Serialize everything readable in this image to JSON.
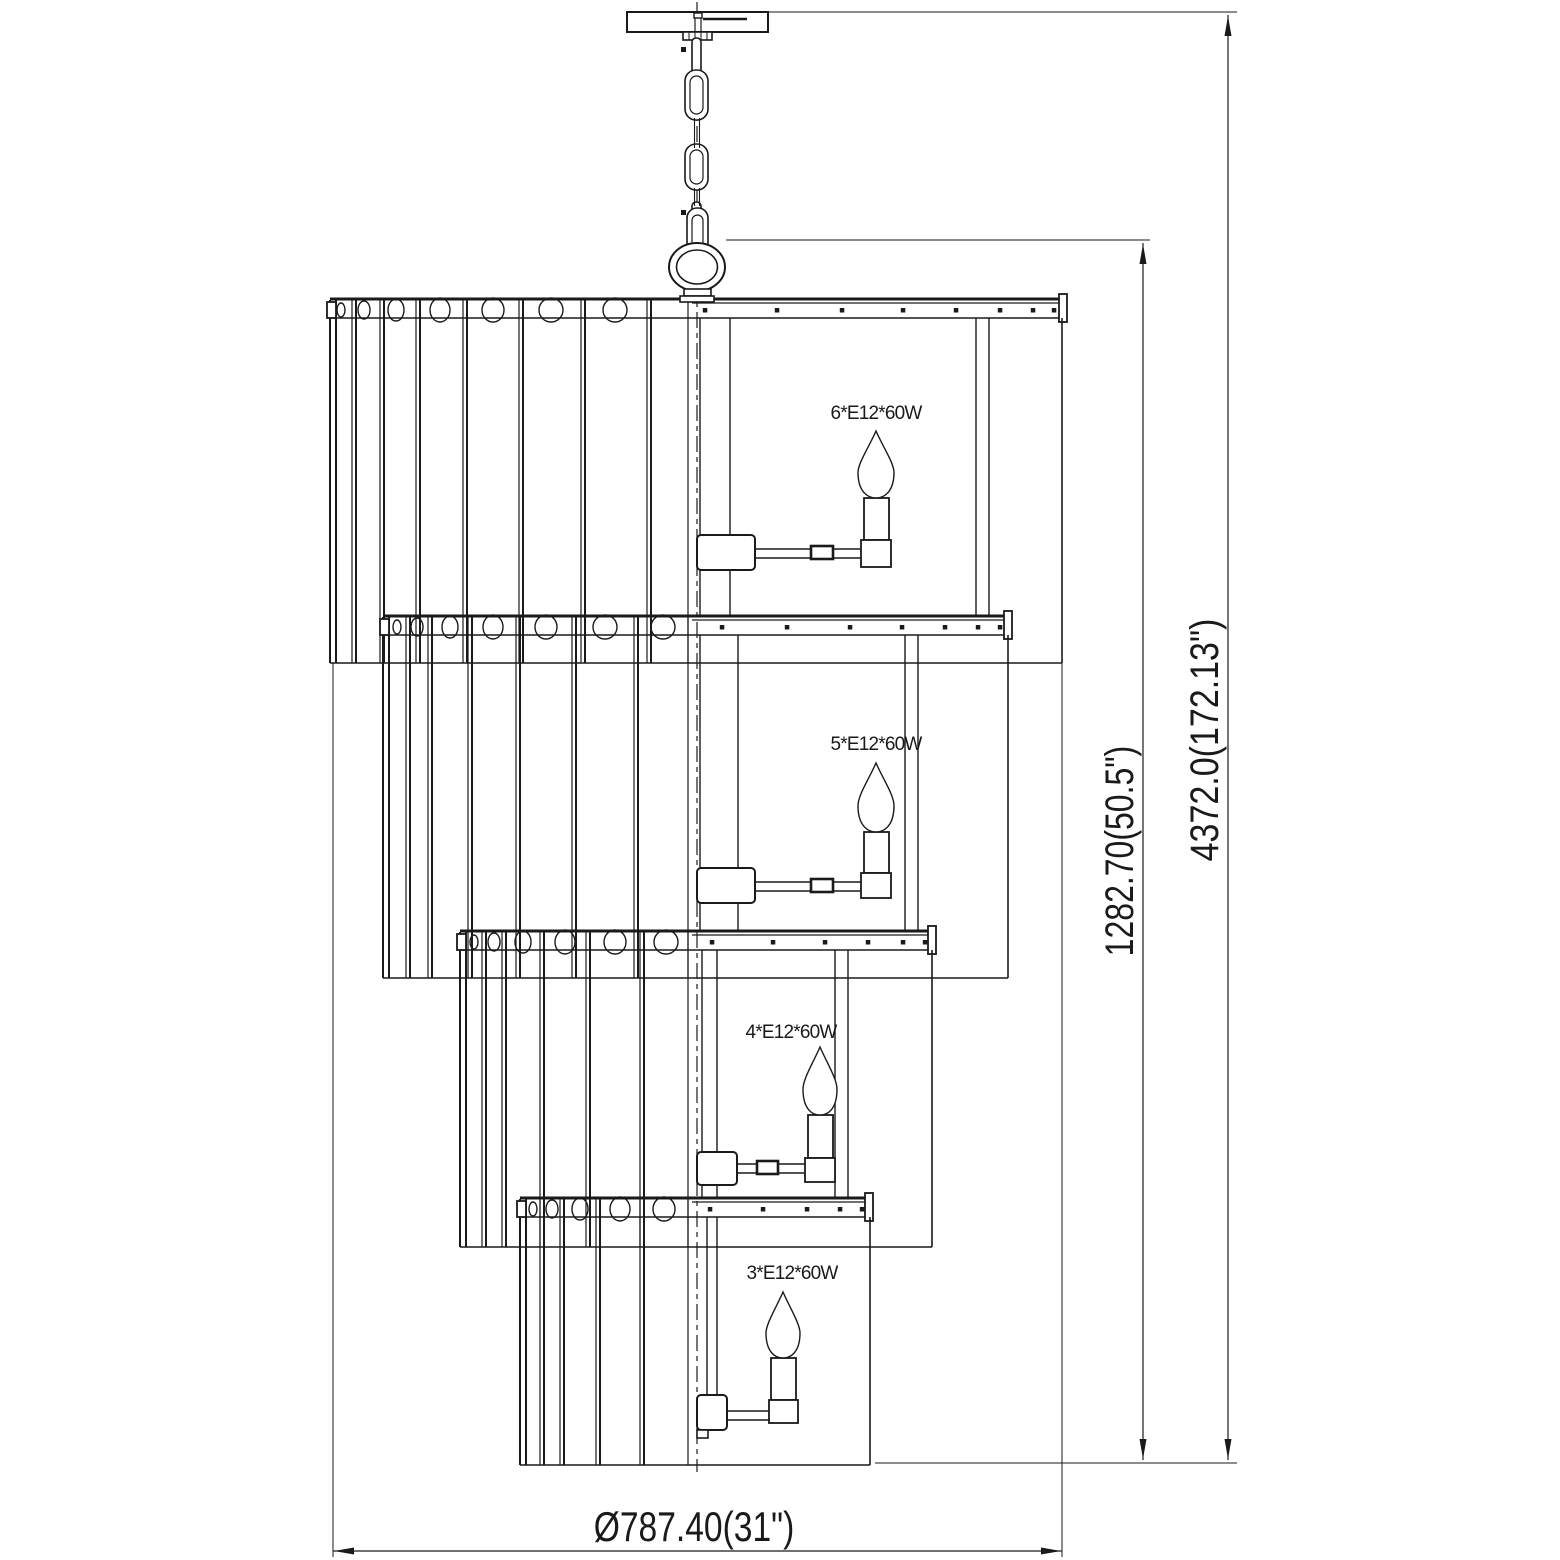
{
  "labels": {
    "tier1_lamp": "6*E12*60W",
    "tier2_lamp": "5*E12*60W",
    "tier3_lamp": "4*E12*60W",
    "tier4_lamp": "3*E12*60W",
    "height_body": "1282.70(50.5\")",
    "height_overall": "4372.0(172.13\")",
    "width_overall": "Ø787.40(31\")"
  },
  "colors": {
    "ink": "#1a1a1a",
    "background": "#ffffff"
  },
  "geometry": {
    "center_x": 697,
    "center_line": {
      "y1": 2,
      "y2": 1472,
      "dash": "16 5 5 5"
    },
    "canopy": {
      "plate": [
        627,
        12,
        141,
        20
      ],
      "stem_cap": [
        694,
        13,
        8,
        5
      ],
      "stem_lines": [
        [
          695,
          18,
          32
        ],
        [
          701,
          18,
          32
        ]
      ],
      "inner_bar": [
        703,
        19,
        747
      ],
      "collar": [
        683,
        32,
        29,
        8
      ],
      "collar_ticks": [
        689,
        695,
        701,
        707
      ]
    },
    "chain": {
      "squares": [
        [
          681,
          47
        ],
        [
          681,
          210
        ]
      ],
      "side_links": [
        [
          692,
          38,
          9,
          36
        ],
        [
          692,
          202,
          9,
          34
        ]
      ],
      "oval_links": [
        [
          685,
          70,
          23,
          50
        ],
        [
          685,
          144,
          23,
          46
        ]
      ],
      "inner_ovals": [
        [
          690,
          76,
          13,
          38
        ],
        [
          690,
          150,
          13,
          34
        ]
      ],
      "wires": [
        [
          694.5,
          118,
          148
        ],
        [
          699.5,
          118,
          148
        ],
        [
          694.5,
          188,
          206
        ],
        [
          699.5,
          188,
          206
        ]
      ],
      "hook_outer": [
        687,
        208,
        21,
        54
      ],
      "hook_inner": [
        692,
        215,
        11,
        40
      ]
    },
    "ring": {
      "cx": 697,
      "cy": 267,
      "rx": 28,
      "ry": 24,
      "irx": 20.5,
      "iry": 17,
      "collar": [
        [
          684,
          289,
          27,
          7
        ],
        [
          680,
          296,
          34,
          6
        ]
      ]
    },
    "tiers": [
      {
        "name": "tier-1",
        "rail_y": 298,
        "left": 330,
        "right": 1062,
        "capx": 1059,
        "bottom": 663,
        "lines": [
          [
            330,
            2
          ],
          [
            336,
            2
          ],
          [
            352,
            1.2
          ],
          [
            356,
            2
          ],
          [
            380,
            1.2
          ],
          [
            384,
            2
          ],
          [
            416,
            1.2
          ],
          [
            420,
            2
          ],
          [
            463,
            1.2
          ],
          [
            467,
            2
          ],
          [
            519,
            1.2
          ],
          [
            523,
            2
          ],
          [
            581,
            1.2
          ],
          [
            585,
            2
          ],
          [
            647,
            1.2
          ],
          [
            651,
            2
          ],
          [
            688,
            1.2
          ]
        ],
        "holes": [
          [
            341,
            4
          ],
          [
            364,
            6
          ],
          [
            396,
            8
          ],
          [
            440,
            10
          ],
          [
            493,
            11
          ],
          [
            551,
            12
          ],
          [
            615,
            12
          ]
        ],
        "dots": [
          705,
          777,
          842,
          903,
          956,
          1000,
          1033,
          1054
        ],
        "rods": [
          700,
          730,
          976,
          989
        ],
        "rods_y": [
          318,
          616
        ],
        "hub": [
          697,
          535,
          58,
          35
        ],
        "arm": {
          "y": 549,
          "x1": 755,
          "x2": 864
        },
        "coupler": [
          811,
          546,
          22,
          13
        ],
        "socket": [
          864,
          498,
          25,
          42
        ],
        "holder": [
          861,
          540,
          30,
          27
        ],
        "bulb": {
          "cx": 876,
          "tip": 431,
          "bot": 498,
          "hw": 18
        }
      },
      {
        "name": "tier-2",
        "rail_y": 615,
        "left": 383,
        "right": 1008,
        "capx": 1004,
        "bottom": 978,
        "lines": [
          [
            383,
            2
          ],
          [
            389,
            2
          ],
          [
            406,
            1.2
          ],
          [
            410,
            2
          ],
          [
            428,
            1.2
          ],
          [
            432,
            2
          ],
          [
            468,
            1.2
          ],
          [
            472,
            2
          ],
          [
            516,
            1.2
          ],
          [
            520,
            2
          ],
          [
            572,
            1.2
          ],
          [
            576,
            2
          ],
          [
            634,
            1.2
          ],
          [
            638,
            2
          ],
          [
            688,
            1.2
          ]
        ],
        "holes": [
          [
            397,
            4
          ],
          [
            417,
            6
          ],
          [
            450,
            8
          ],
          [
            493,
            10
          ],
          [
            546,
            11
          ],
          [
            605,
            12
          ],
          [
            663,
            12
          ]
        ],
        "dots": [
          722,
          787,
          850,
          902,
          945,
          978,
          1000
        ],
        "rods": [
          700,
          738,
          905,
          918
        ],
        "rods_y": [
          635,
          931
        ],
        "hub": [
          697,
          868,
          58,
          35
        ],
        "arm": {
          "y": 882,
          "x1": 755,
          "x2": 864
        },
        "coupler": [
          811,
          879,
          22,
          13
        ],
        "socket": [
          864,
          832,
          25,
          41
        ],
        "holder": [
          861,
          873,
          30,
          25
        ],
        "bulb": {
          "cx": 876,
          "tip": 763,
          "bot": 832,
          "hw": 18
        }
      },
      {
        "name": "tier-3",
        "rail_y": 930,
        "left": 460,
        "right": 932,
        "capx": 928,
        "bottom": 1247,
        "lines": [
          [
            460,
            2
          ],
          [
            466,
            2
          ],
          [
            482,
            1.2
          ],
          [
            486,
            2
          ],
          [
            502,
            1.2
          ],
          [
            506,
            2
          ],
          [
            540,
            1.2
          ],
          [
            544,
            2
          ],
          [
            586,
            1.2
          ],
          [
            590,
            2
          ],
          [
            640,
            1.2
          ],
          [
            644,
            2
          ],
          [
            688,
            1.2
          ]
        ],
        "holes": [
          [
            474,
            4
          ],
          [
            494,
            6
          ],
          [
            523,
            8
          ],
          [
            565,
            10
          ],
          [
            615,
            11
          ],
          [
            666,
            12
          ]
        ],
        "dots": [
          712,
          773,
          825,
          868,
          903,
          925
        ],
        "rods": [
          702,
          717,
          835,
          848
        ],
        "rods_y": [
          950,
          1198
        ],
        "hub": [
          697,
          1152,
          40,
          33
        ],
        "arm": {
          "y": 1164,
          "x1": 737,
          "x2": 808
        },
        "coupler": [
          757,
          1161,
          21,
          13
        ],
        "socket": [
          808,
          1115,
          25,
          43
        ],
        "holder": [
          805,
          1158,
          30,
          24
        ],
        "bulb": {
          "cx": 820,
          "tip": 1047,
          "bot": 1115,
          "hw": 17
        }
      },
      {
        "name": "tier-4",
        "rail_y": 1197,
        "left": 520,
        "right": 870,
        "capx": 865,
        "bottom": 1465,
        "lines": [
          [
            520,
            2
          ],
          [
            526,
            2
          ],
          [
            540,
            1.2
          ],
          [
            544,
            2
          ],
          [
            560,
            1.2
          ],
          [
            564,
            2
          ],
          [
            596,
            1.2
          ],
          [
            600,
            2
          ],
          [
            640,
            1.2
          ],
          [
            644,
            2
          ],
          [
            688,
            1.2
          ]
        ],
        "holes": [
          [
            533,
            4
          ],
          [
            552,
            6
          ],
          [
            580,
            8
          ],
          [
            620,
            10
          ],
          [
            664,
            11
          ]
        ],
        "dots": [
          710,
          763,
          807,
          840,
          862
        ],
        "rods": [
          707,
          717
        ],
        "rods_y": [
          1217,
          1397
        ],
        "hub": [
          697,
          1395,
          30,
          35
        ],
        "step": [
          697,
          1430,
          11,
          8
        ],
        "arm": {
          "y": 1411,
          "x1": 727,
          "x2": 771
        },
        "socket": [
          771,
          1358,
          25,
          42
        ],
        "holder": [
          769,
          1400,
          29,
          23
        ],
        "bulb": {
          "cx": 783,
          "tip": 1292,
          "bot": 1358,
          "hw": 17
        }
      }
    ],
    "dimensions": {
      "width": {
        "line_y": 1551,
        "x1": 333,
        "x2": 1062,
        "ext_left": [
          333,
          663,
          1557
        ],
        "ext_right": [
          1062,
          320,
          1557
        ]
      },
      "inner": {
        "line_x": 1143,
        "y1": 243,
        "y2": 1460,
        "top_ext": [
          240,
          726,
          1150
        ],
        "bottom_ext": [
          1463,
          875,
          1237
        ]
      },
      "outer": {
        "line_x": 1228,
        "y1": 15,
        "y2": 1460,
        "top_ext": [
          12,
          768,
          1237
        ]
      }
    }
  }
}
